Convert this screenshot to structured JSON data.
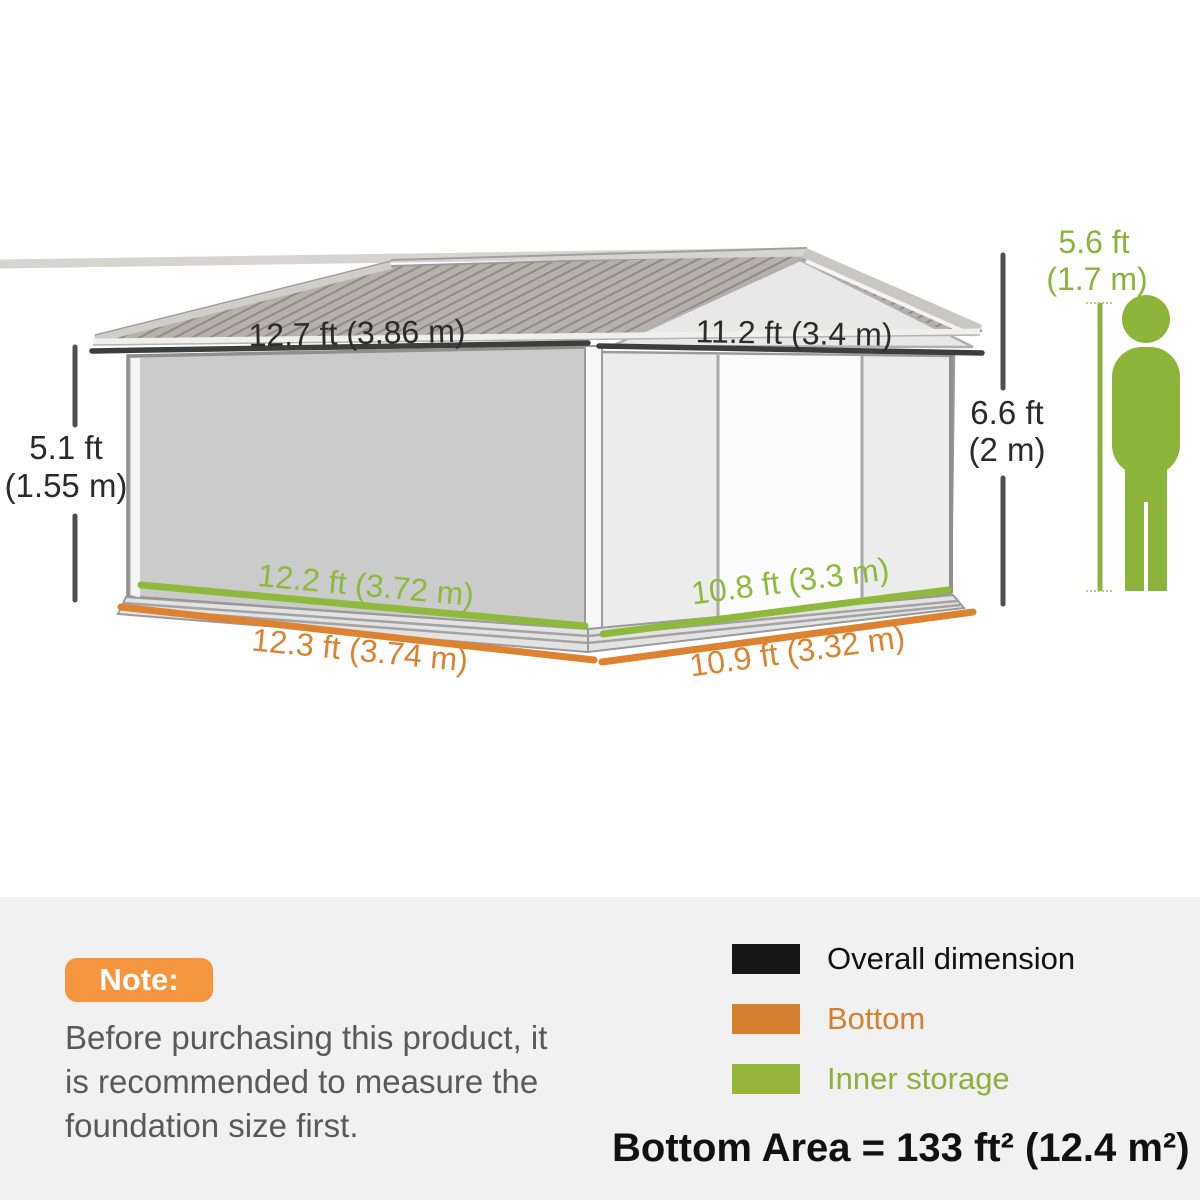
{
  "shed_diagram": {
    "overall_dimensions": {
      "roof_side": "12.7 ft (3.86 m)",
      "roof_front": "11.2 ft (3.4 m)",
      "wall_height": {
        "ft": "5.1 ft",
        "m": "(1.55 m)"
      },
      "peak_height": {
        "ft": "6.6 ft",
        "m": "(2 m)"
      }
    },
    "inner_storage": {
      "side": "12.2 ft (3.72 m)",
      "front": "10.8 ft (3.3 m)"
    },
    "bottom": {
      "side": "12.3 ft (3.74 m)",
      "front": "10.9 ft (3.32 m)"
    },
    "person_height": {
      "ft": "5.6 ft",
      "m": "(1.7 m)"
    },
    "colors": {
      "overall_line": "#3d3d3d",
      "dimension_line": "#4f4f4f",
      "bottom_line": "#dc8230",
      "inner_storage_line": "#8fb93c",
      "person_green": "#8cb33a",
      "dimension_text": "#2b2b2b"
    }
  },
  "note": {
    "badge": "Note:",
    "badge_color": "#f5953e",
    "lines": [
      "Before purchasing this product, it",
      "is recommended to measure the",
      "foundation size first."
    ]
  },
  "legend": {
    "items": [
      {
        "label": "Overall dimension",
        "swatch": "#161616",
        "text": "#111111"
      },
      {
        "label": "Bottom",
        "swatch": "#d4802e",
        "text": "#d4802e"
      },
      {
        "label": "Inner storage",
        "swatch": "#95b53a",
        "text": "#8fae3c"
      }
    ]
  },
  "footer": {
    "bottom_area": "Bottom Area = 133 ft² (12.4 m²)"
  }
}
